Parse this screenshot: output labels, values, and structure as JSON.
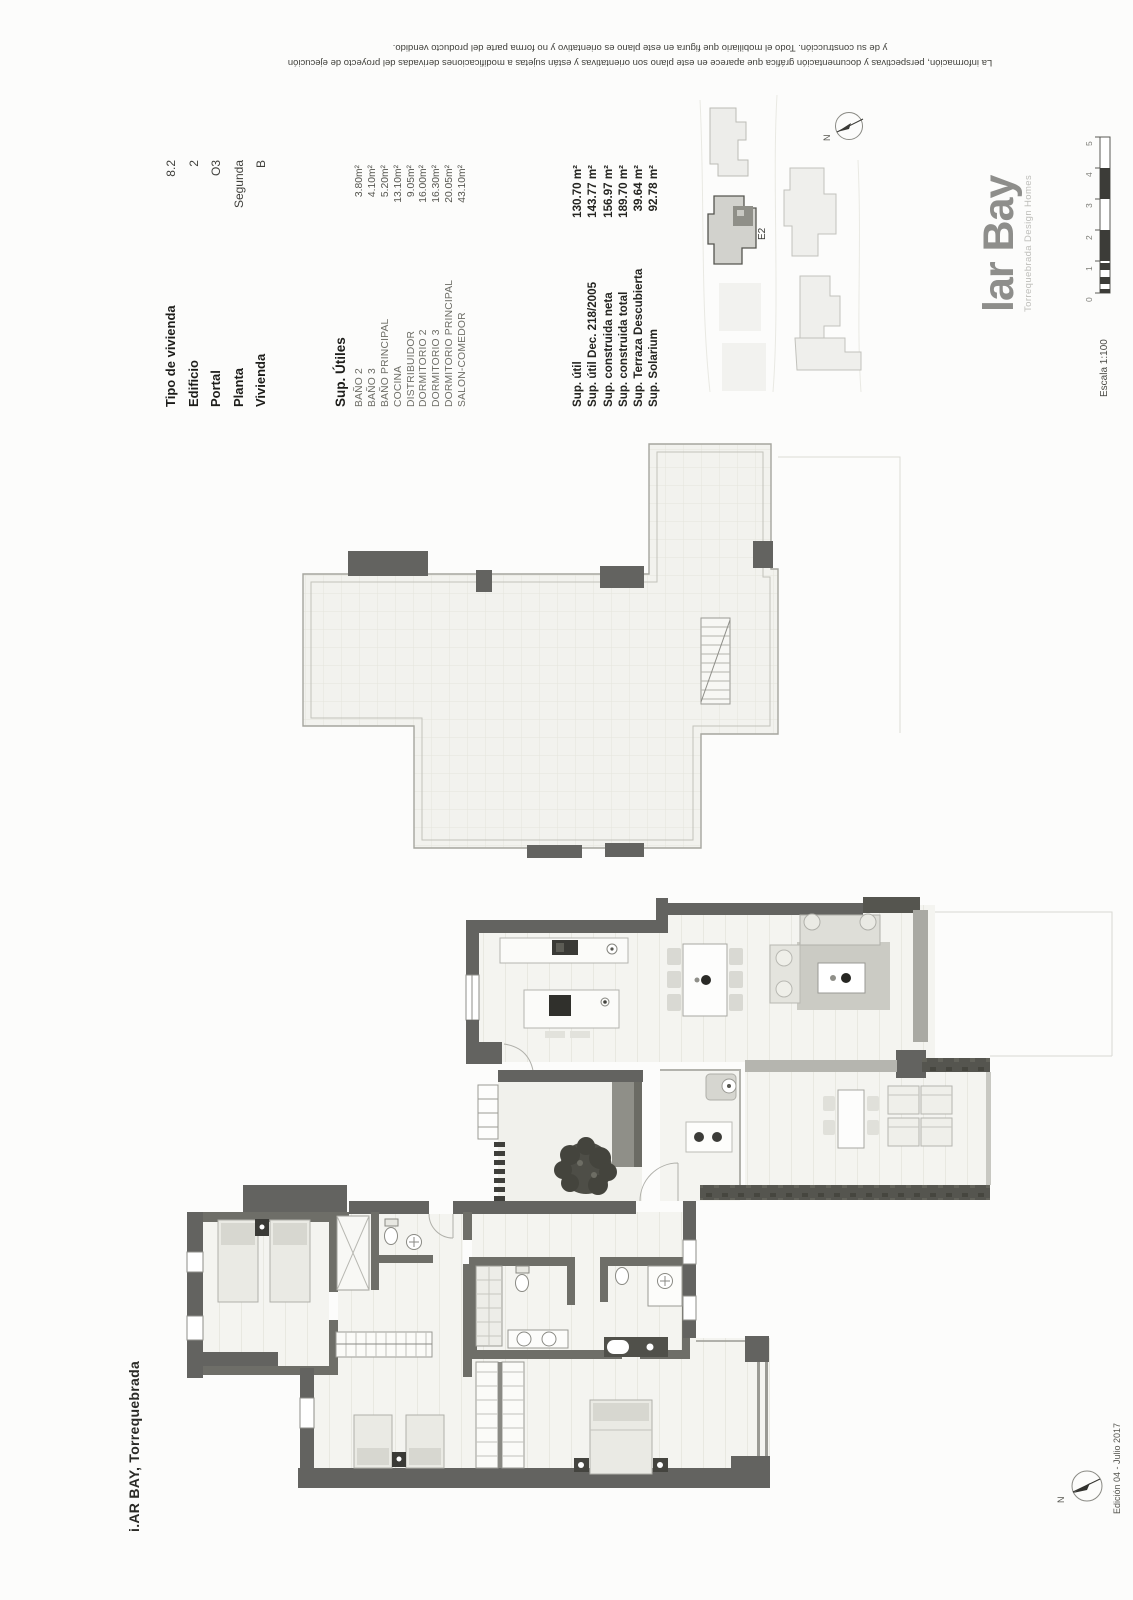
{
  "disclaimer": {
    "line1": "La información, perspectivas y documentación gráfica que aparece en este plano son orientativas y están sujetas a modificaciones derivadas del proyecto de ejecución",
    "line2": "y de su construcción. Todo el mobiliario que figura en este plano es orientativo y no forma parte del producto vendido."
  },
  "unit_info": {
    "rows": [
      {
        "label": "Tipo de vivienda",
        "value": "8.2"
      },
      {
        "label": "Edificio",
        "value": "2"
      },
      {
        "label": "Portal",
        "value": "O3"
      },
      {
        "label": "Planta",
        "value": "Segunda"
      },
      {
        "label": "Vivienda",
        "value": "B"
      }
    ]
  },
  "sup_utiles": {
    "title": "Sup. Útiles",
    "items": [
      {
        "label": "BAÑO 2",
        "value": "3.80m²"
      },
      {
        "label": "BAÑO 3",
        "value": "4.10m²"
      },
      {
        "label": "BAÑO PRINCIPAL",
        "value": "5.20m²"
      },
      {
        "label": "COCINA",
        "value": "13.10m²"
      },
      {
        "label": "DISTRIBUIDOR",
        "value": "9.05m²"
      },
      {
        "label": "DORMITORIO 2",
        "value": "16.00m²"
      },
      {
        "label": "DORMITORIO 3",
        "value": "16.30m²"
      },
      {
        "label": "DORMITORIO PRINCIPAL",
        "value": "20.05m²"
      },
      {
        "label": "SALON-COMEDOR",
        "value": "43.10m²"
      }
    ]
  },
  "summary": {
    "rows": [
      {
        "label": "Sup. útil",
        "value": "130.70 m²"
      },
      {
        "label": "Sup. útil Dec. 218/2005",
        "value": "143.77 m²"
      },
      {
        "label": "Sup. construida neta",
        "value": "156.97 m²"
      },
      {
        "label": "Sup. construida total",
        "value": "189.70 m²"
      },
      {
        "label": "Sup. Terraza Descubierta",
        "value": "39.64 m²"
      },
      {
        "label": "Sup. Solarium",
        "value": "92.78 m²"
      }
    ]
  },
  "project_title": "i.AR BAY, Torrequebrada",
  "logo": {
    "name": "lar Bay",
    "tagline": "Torrequebrada Design Homes"
  },
  "scale_bar": {
    "label": "Escala 1:100",
    "ticks": [
      "0",
      "1",
      "2",
      "3",
      "4",
      "5"
    ]
  },
  "site_plan": {
    "unit_label": "E2",
    "north_label": "N"
  },
  "compass": {
    "north_label": "N"
  },
  "edition": "Edición 04 - Julio 2017",
  "colors": {
    "wall": "#636360",
    "wall_dark": "#55554f",
    "paper": "#fcfcfb",
    "highlight_unit": "#8f8f88"
  }
}
